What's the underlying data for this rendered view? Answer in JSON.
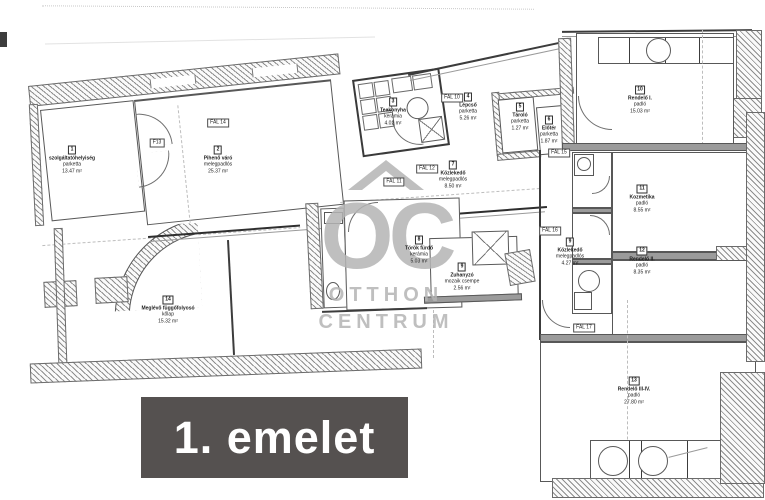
{
  "banner": {
    "text": "1. emelet"
  },
  "watermark": {
    "monogram": "OC",
    "line1": "OTTHON",
    "line2": "CENTRUM"
  },
  "colors": {
    "banner_bg": "#555150",
    "banner_fg": "#ffffff",
    "watermark": "#b5b5b5",
    "ink": "#4a4a4a"
  },
  "rooms": [
    {
      "num": "1",
      "name": "szolgáltatóhelyiség",
      "floor": "parketta",
      "area": "13.47 m²",
      "x": 72,
      "y": 160
    },
    {
      "num": "2",
      "name": "Pihenő váró",
      "floor": "melegpadlós",
      "area": "25.37 m²",
      "x": 218,
      "y": 160
    },
    {
      "num": "3",
      "name": "Teakonyha",
      "floor": "kerámia",
      "area": "4.02 m²",
      "x": 393,
      "y": 112
    },
    {
      "num": "4",
      "name": "Lépcső",
      "floor": "parketta",
      "area": "5.26 m²",
      "x": 468,
      "y": 107
    },
    {
      "num": "5",
      "name": "Tároló",
      "floor": "parketta",
      "area": "1.27 m²",
      "x": 520,
      "y": 117
    },
    {
      "num": "6",
      "name": "Előtér",
      "floor": "parketta",
      "area": "1.87 m²",
      "x": 549,
      "y": 130
    },
    {
      "num": "7",
      "name": "Közlekedő",
      "floor": "melegpadlós",
      "area": "8.50 m²",
      "x": 453,
      "y": 175
    },
    {
      "num": "8",
      "name": "Török fürdő",
      "floor": "kerámia",
      "area": "5.03 m²",
      "x": 419,
      "y": 250
    },
    {
      "num": "9",
      "name": "Zuhanyzó",
      "floor": "mozaik csempe",
      "area": "2.56 m²",
      "x": 462,
      "y": 277
    },
    {
      "num": "9",
      "name": "Közlekedő",
      "floor": "melegpadlós",
      "area": "4.27 m²",
      "x": 570,
      "y": 252
    },
    {
      "num": "10",
      "name": "Rendelő I.",
      "floor": "padló",
      "area": "15.03 m²",
      "x": 640,
      "y": 100
    },
    {
      "num": "11",
      "name": "Kozmetika",
      "floor": "padló",
      "area": "8.55 m²",
      "x": 642,
      "y": 199
    },
    {
      "num": "12",
      "name": "Rendelő II.",
      "floor": "padló",
      "area": "8.35 m²",
      "x": 642,
      "y": 261
    },
    {
      "num": "13",
      "name": "Rendelő III-IV.",
      "floor": "padló",
      "area": "27.80 m²",
      "x": 634,
      "y": 391
    },
    {
      "num": "14",
      "name": "Meglévő függőfolyosó",
      "floor": "kőlap",
      "area": "15.32 m²",
      "x": 168,
      "y": 310
    }
  ],
  "wall_tags": [
    {
      "label": "F13",
      "x": 157,
      "y": 143
    },
    {
      "label": "FAL 14",
      "x": 218,
      "y": 123
    },
    {
      "label": "FAL 10",
      "x": 452,
      "y": 98
    },
    {
      "label": "FAL 11",
      "x": 394,
      "y": 182
    },
    {
      "label": "FAL 12",
      "x": 427,
      "y": 169
    },
    {
      "label": "FAL 15",
      "x": 559,
      "y": 153
    },
    {
      "label": "FAL 16",
      "x": 550,
      "y": 231
    },
    {
      "label": "FAL 17",
      "x": 584,
      "y": 328
    }
  ]
}
